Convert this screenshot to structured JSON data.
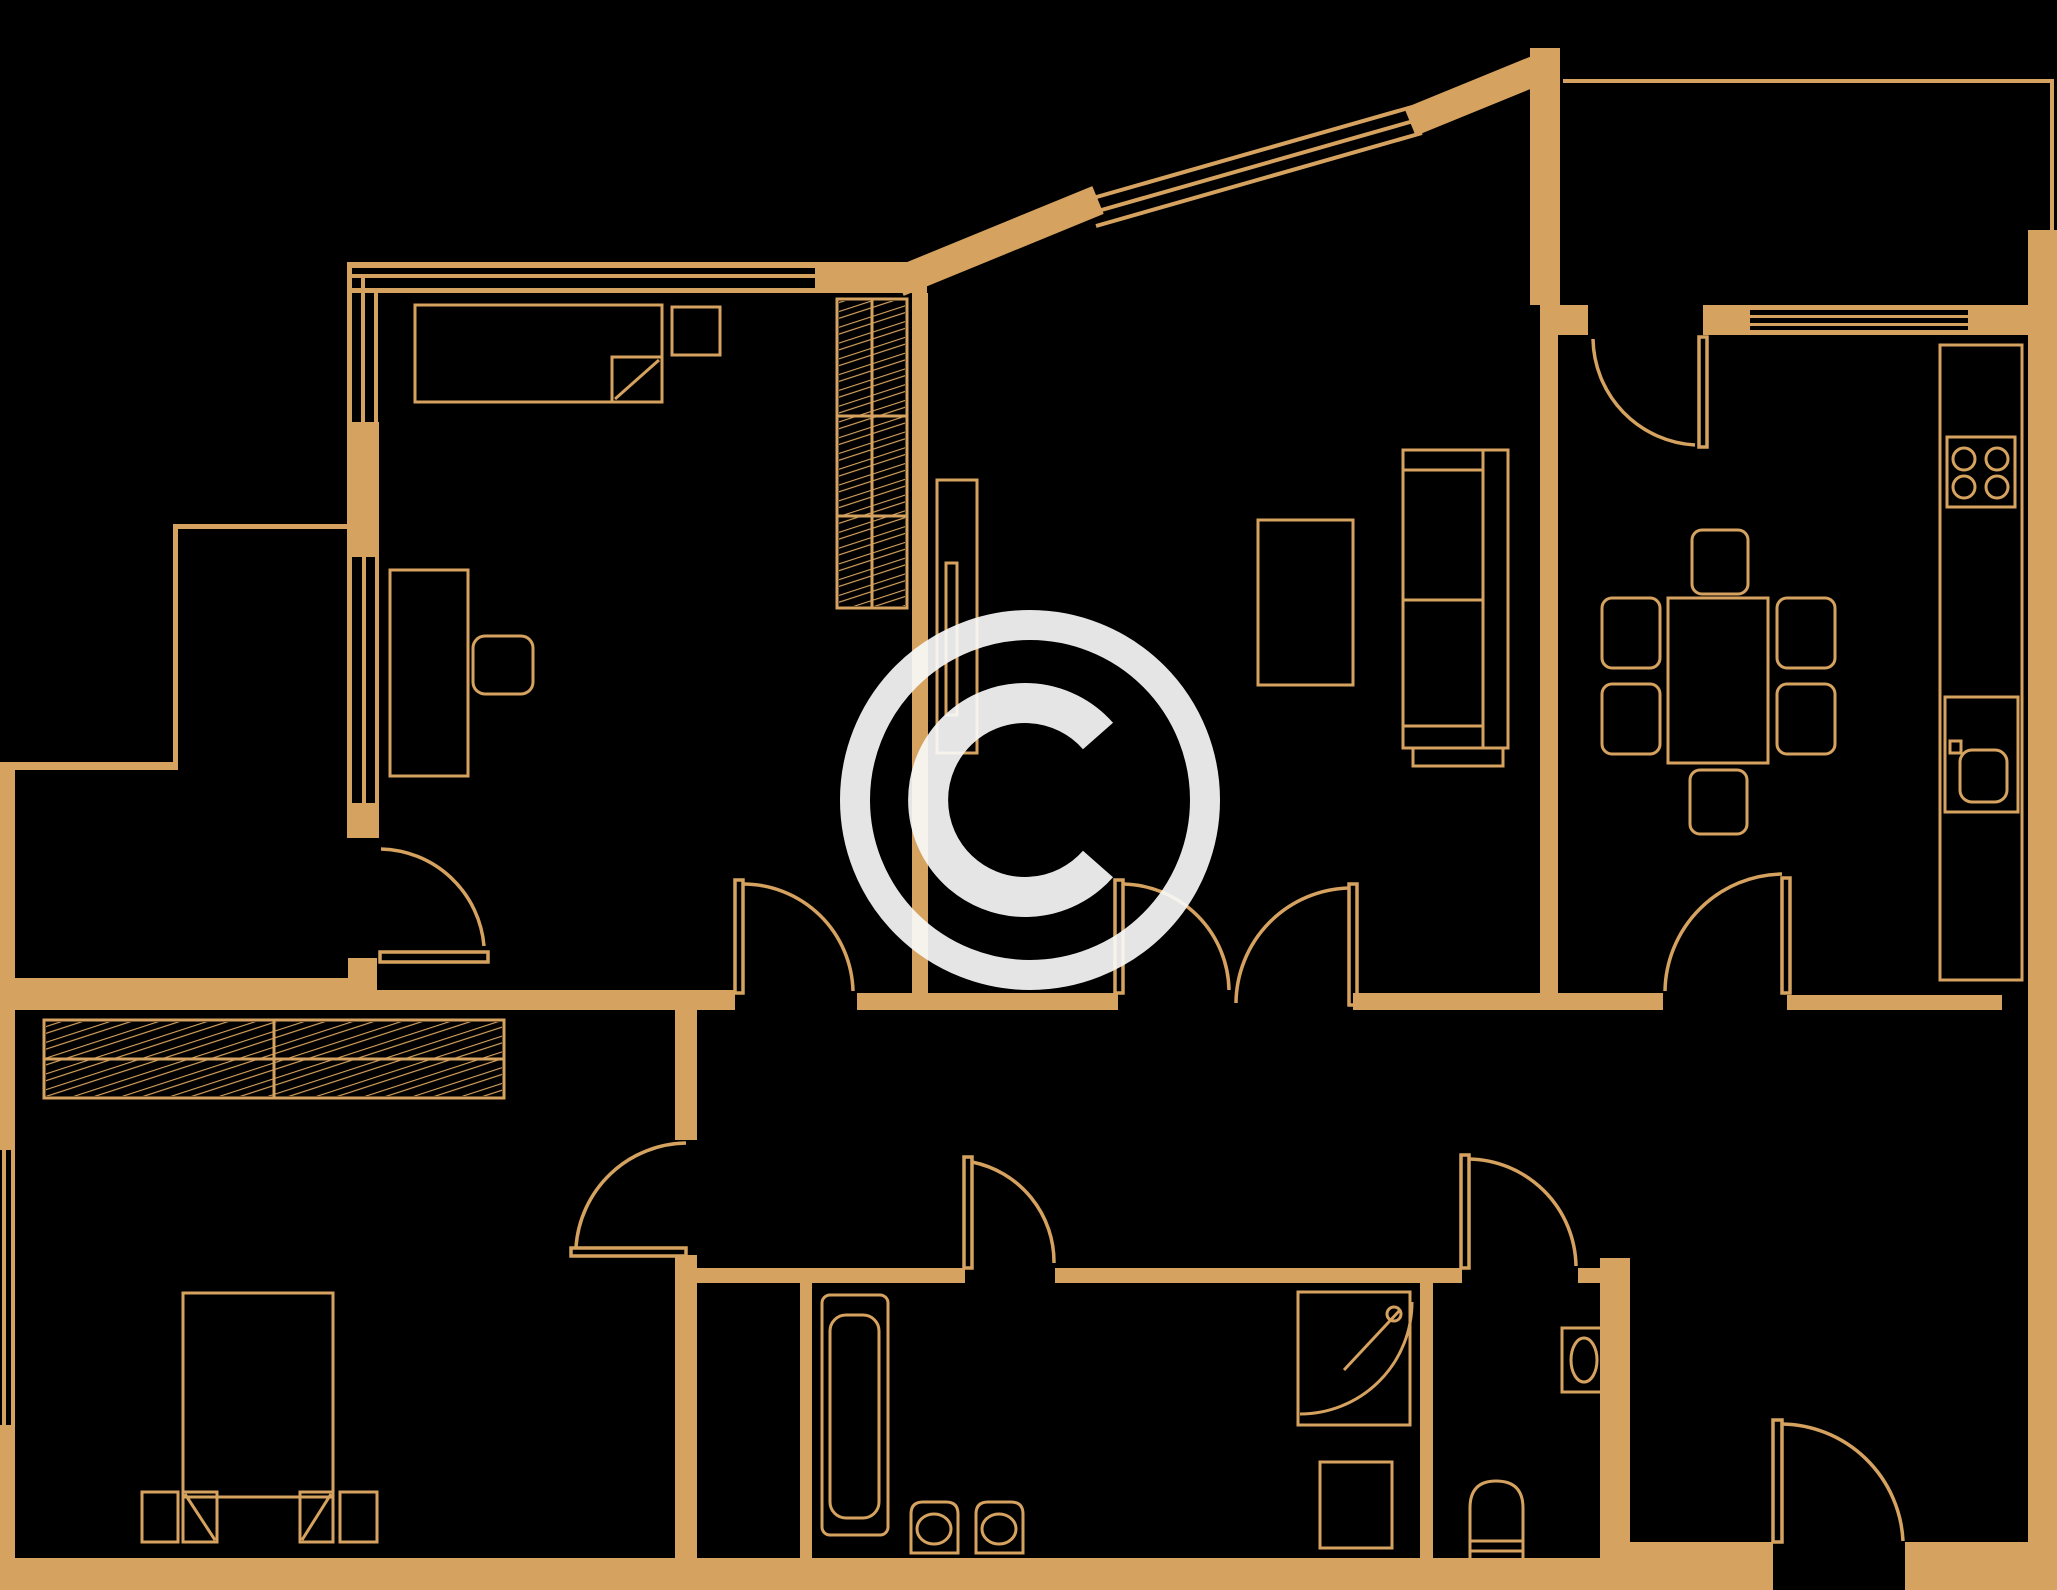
{
  "meta": {
    "kind": "apartment floor plan drawing",
    "watermark_symbol": "©",
    "watermark_label": "copyright watermark"
  },
  "colors": {
    "background": "#000000",
    "plan_lines": "#D6A25F",
    "watermark": "#F8F8F8"
  },
  "inventory": {
    "rooms": [
      {
        "label": "bedroom-top-left",
        "furniture": [
          "bed",
          "nightstand",
          "desk",
          "desk-chair",
          "tall-wardrobe"
        ]
      },
      {
        "label": "balcony-left",
        "furniture": []
      },
      {
        "label": "living-room",
        "furniture": [
          "sofa",
          "coffee-table",
          "tv-board"
        ]
      },
      {
        "label": "kitchen",
        "furniture": [
          "dining-table",
          "six-chairs",
          "counter",
          "stove",
          "sink"
        ]
      },
      {
        "label": "balcony-top-right",
        "furniture": []
      },
      {
        "label": "bedroom-bottom-left",
        "furniture": [
          "double-bed",
          "two-pillows",
          "two-nightstands",
          "two-wardrobes"
        ]
      },
      {
        "label": "bathroom",
        "furniture": [
          "bathtub",
          "two-washbasins",
          "shower",
          "washing-machine"
        ]
      },
      {
        "label": "wc",
        "furniture": [
          "toilet",
          "washbasin"
        ]
      },
      {
        "label": "hall",
        "furniture": []
      }
    ],
    "door_count": 9,
    "window_count": 4
  }
}
